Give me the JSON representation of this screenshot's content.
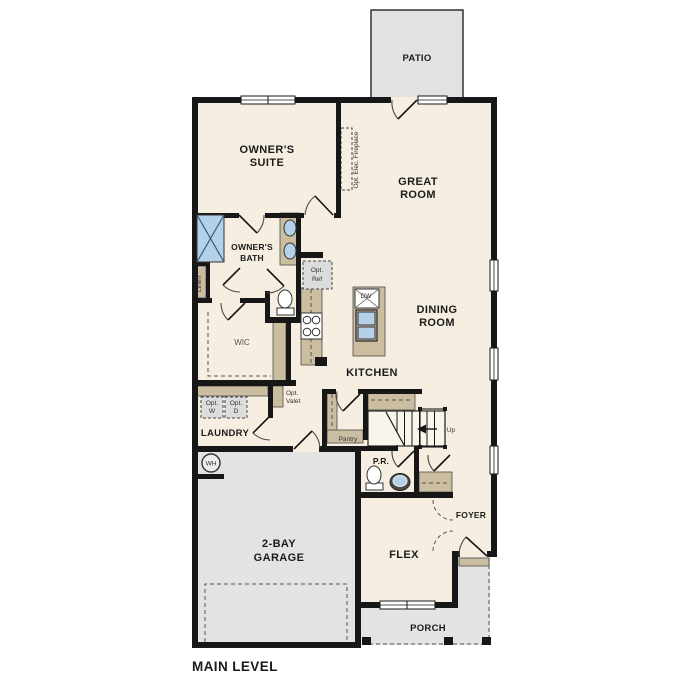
{
  "page": {
    "title": "MAIN LEVEL"
  },
  "colors": {
    "wall": "#171717",
    "floor": "#f6efe1",
    "concrete": "#e3e3e3",
    "cabinet_tan": "#cbbda0",
    "fixture_blue": "#b3d2ea",
    "dashed_gray": "#dcdcdc"
  },
  "rooms": {
    "patio": "PATIO",
    "owners_suite": [
      "OWNER'S",
      "SUITE"
    ],
    "great_room": [
      "GREAT",
      "ROOM"
    ],
    "owners_bath": [
      "OWNER'S",
      "BATH"
    ],
    "wic": "WIC",
    "dining_room": [
      "DINING",
      "ROOM"
    ],
    "kitchen": "KITCHEN",
    "laundry": "LAUNDRY",
    "pantry": "Pantry",
    "powder_room": "P.R.",
    "foyer": "FOYER",
    "flex": "FLEX",
    "garage": [
      "2-BAY",
      "GARAGE"
    ],
    "porch": "PORCH"
  },
  "annotations": {
    "opt_elec_fireplace": "Opt. Elec. Fireplace",
    "linen": "Linen",
    "opt_ref": [
      "Opt.",
      "Ref"
    ],
    "opt_washer": [
      "Opt.",
      "W"
    ],
    "opt_dryer": [
      "Opt.",
      "D"
    ],
    "opt_valet": [
      "Opt.",
      "Valet"
    ],
    "dishwasher": "DW",
    "stairs_up": "Up",
    "water_heater": "WH"
  }
}
